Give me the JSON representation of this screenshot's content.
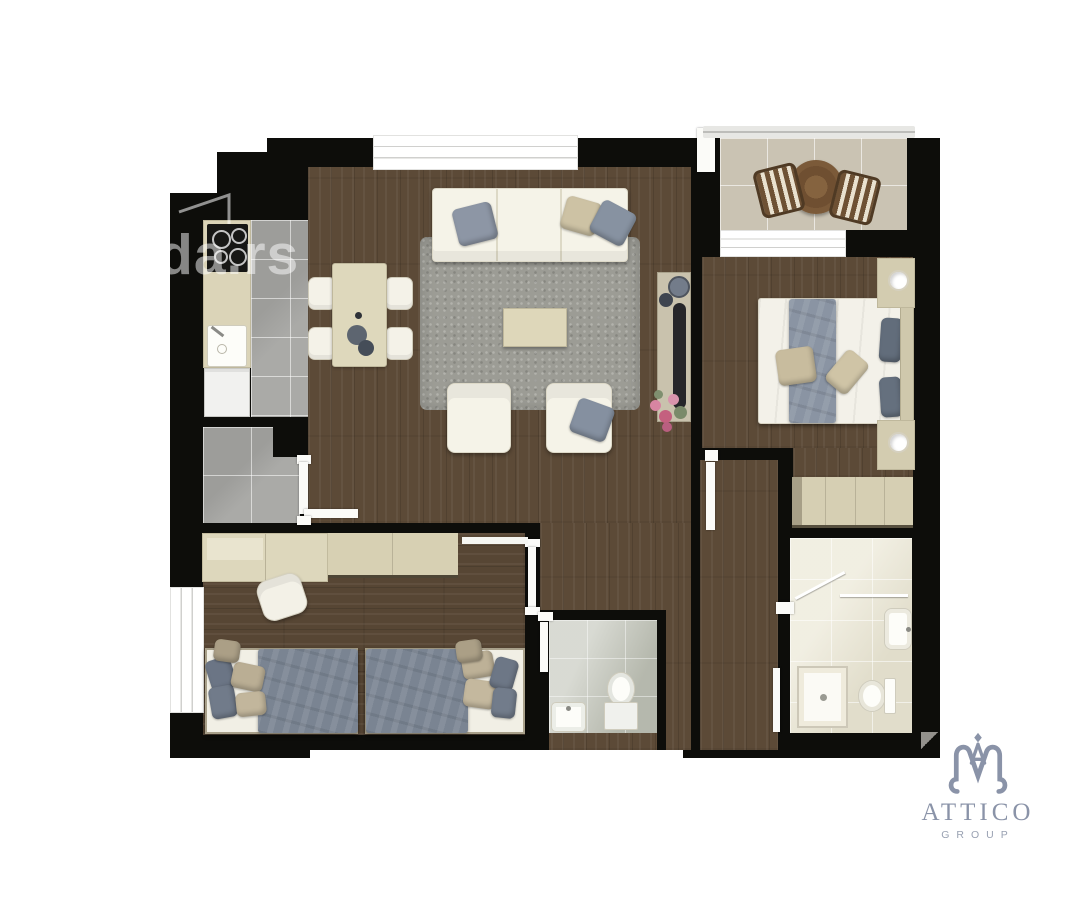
{
  "watermark": {
    "text": "da.rs"
  },
  "brand": {
    "name": "ATTICO",
    "subtitle": "GROUP",
    "color": "#8a93a8"
  },
  "palette": {
    "wall": "#0d0d0a",
    "wood_floor": "#5c4a37",
    "kitchen_tile": "#a5a5a2",
    "balcony_tile": "#cac3b3",
    "bathroom_tile": "#eae6d3",
    "wc_tile": "#bfc2b6",
    "rug": "#9c9c95",
    "sofa_white": "#f5f3e8",
    "furniture_beige": "#ddd7bc",
    "pillow_gray": "#8d96a5",
    "pillow_beige": "#cdc2a4",
    "duvet_gray": "#7a8492",
    "logo_slate": "#8a93a8"
  }
}
